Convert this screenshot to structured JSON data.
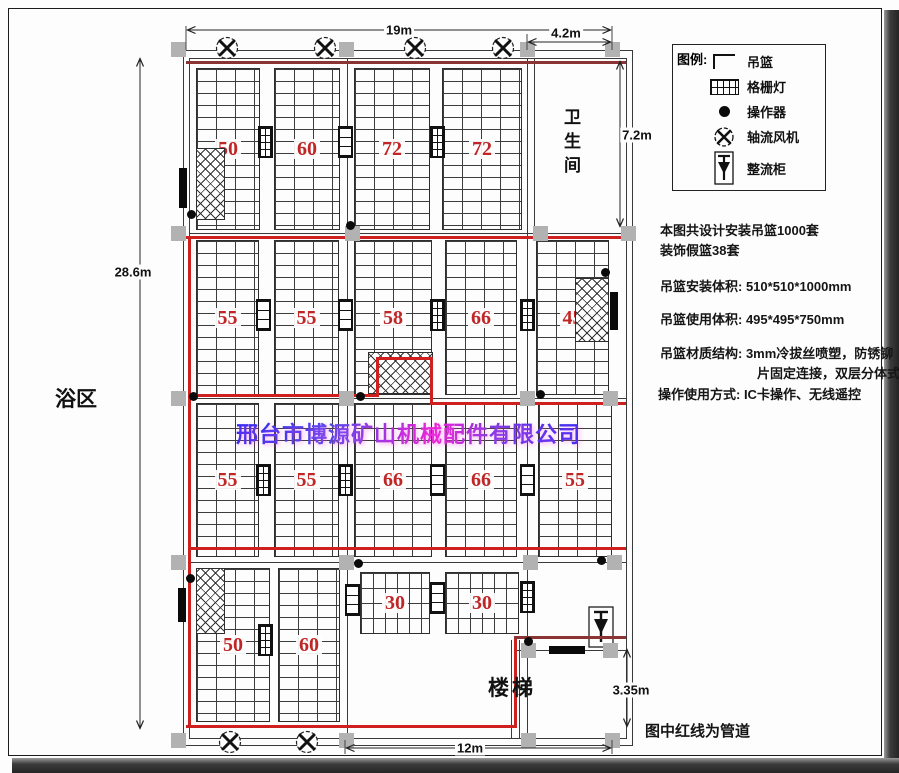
{
  "legend": {
    "title": "图例:",
    "items": [
      {
        "icon": "basket-icon",
        "label": "吊篮"
      },
      {
        "icon": "grille-light-icon",
        "label": "格栅灯"
      },
      {
        "icon": "operator-icon",
        "label": "操作器"
      },
      {
        "icon": "axial-fan-icon",
        "label": "轴流风机"
      },
      {
        "icon": "rectifier-cabinet-icon",
        "label": "整流柜"
      }
    ]
  },
  "notes": {
    "line1": "本图共设计安装吊篮1000套",
    "line2": "装饰假篮38套",
    "install_volume": "吊篮安装体积: 510*510*1000mm",
    "use_volume": "吊篮使用体积: 495*495*750mm",
    "material_line1": "吊篮材质结构: 3mm冷拔丝喷塑，防锈铆",
    "material_line2": "片固定连接，双层分体式",
    "operation": "操作使用方式: IC卡操作、无线遥控",
    "pipe_note": "图中红线为管道"
  },
  "rooms": {
    "bathroom": "卫生间",
    "bath_area": "浴区",
    "stairs": "楼梯"
  },
  "dimensions": {
    "top_width": "19m",
    "top_right_width": "4.2m",
    "bathroom_height": "7.2m",
    "left_height": "28.6m",
    "stairs_height": "3.35m",
    "bottom_width": "12m"
  },
  "watermark": "邢台市博源矿山机械配件有限公司",
  "blocks": {
    "row1": [
      "50",
      "60",
      "72",
      "72"
    ],
    "row2": [
      "55",
      "55",
      "58",
      "66",
      "45"
    ],
    "row3": [
      "55",
      "55",
      "66",
      "66",
      "55"
    ],
    "row4_tall": [
      "50",
      "60"
    ],
    "row4_shallow": [
      "30",
      "30"
    ]
  },
  "colors": {
    "pipe_red": "#cf2020",
    "number_red": "#c02626",
    "column_gray": "#b2b2b2",
    "watermark_blue": "#2a2af0",
    "watermark_magenta": "#ea1ed2"
  }
}
